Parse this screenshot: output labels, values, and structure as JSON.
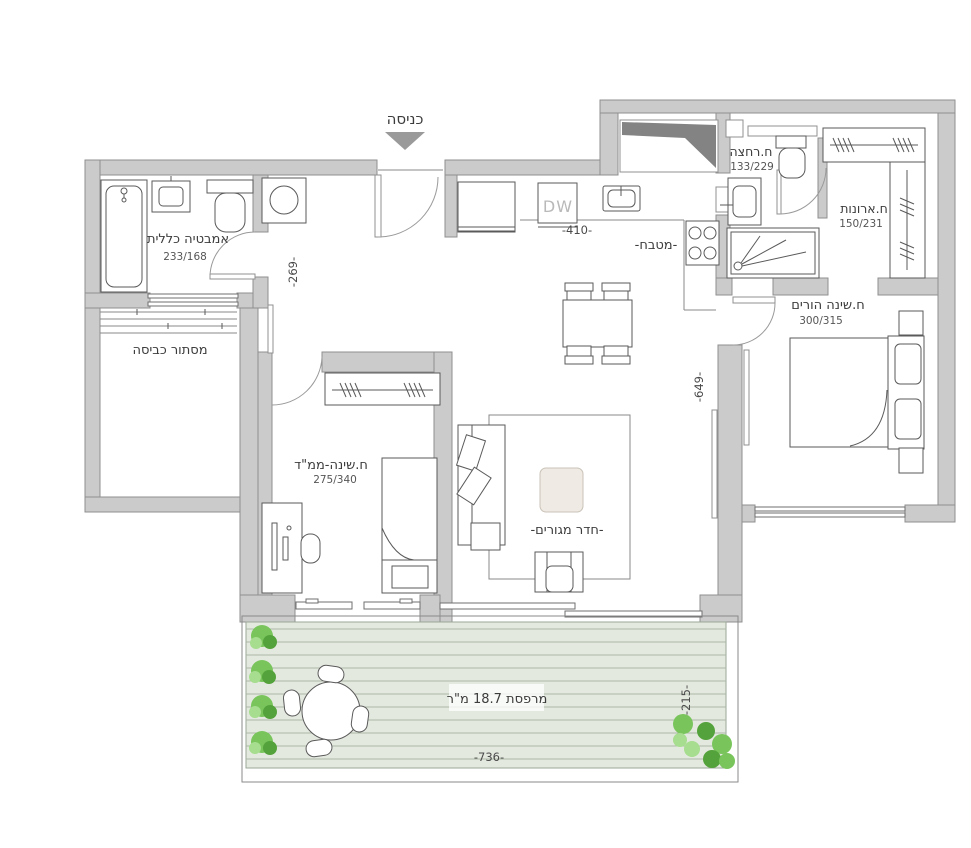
{
  "plan": {
    "entrance": {
      "label": "כניסה"
    },
    "rooms": {
      "bath_main": {
        "name": "אמבטיה כללית",
        "dims": "233/168"
      },
      "laundry": {
        "name": "מסתור כביסה"
      },
      "kitchen": {
        "name": "-מטבח-"
      },
      "bath_shower": {
        "name": "ח.רחצה",
        "dims": "133/229"
      },
      "closet": {
        "name": "ח.ארונות",
        "dims": "150/231"
      },
      "master": {
        "name": "ח.שינה הורים",
        "dims": "300/315"
      },
      "living": {
        "name": "-חדר מגורים-"
      },
      "mamad": {
        "name": "ח.שינה-ממ\"ד",
        "dims": "275/340"
      },
      "balcony": {
        "name": "מרפסת 18.7 מ\"ר"
      }
    },
    "dims": {
      "hall": "-269-",
      "kitchen": "-410-",
      "living": "-649-",
      "balcony_width": "-736-",
      "balcony_depth": "-215-"
    },
    "appliances": {
      "dishwasher_label": "DW"
    },
    "colors": {
      "wall": "#cbcbcb",
      "deck": "#e4e9e0",
      "deck-stripe": "#adb8a7",
      "text": "#3c3c3c",
      "plant": "#79c55c",
      "coffee-table": "#efeae3"
    }
  }
}
